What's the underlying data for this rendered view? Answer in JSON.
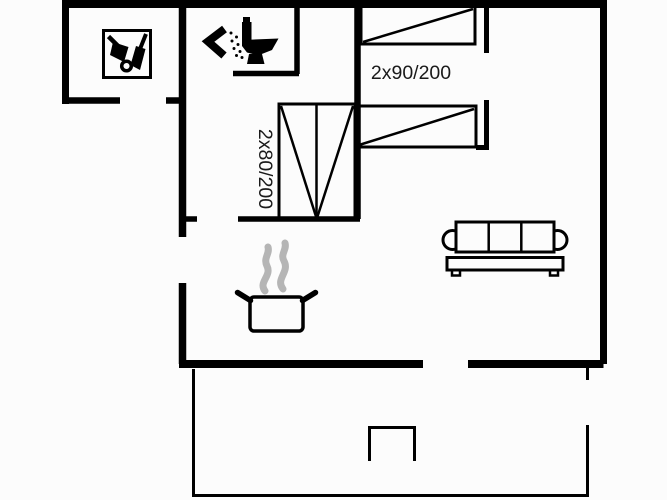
{
  "canvas": {
    "width": 667,
    "height": 500,
    "background": "#fcfcfc",
    "line_color": "#000000",
    "steam_color": "#b5b5b5",
    "text_color": "#1a1a1a"
  },
  "floorplan": {
    "labels": {
      "double_beds": "2x90/200",
      "bunk_bed": "2x80/200"
    },
    "symbols": [
      "garden-tools-icon",
      "shower-icon",
      "toilet-icon",
      "single-bed-symbol",
      "single-bed-symbol",
      "bunk-bed-symbol",
      "sofa-symbol",
      "cooking-pot-icon",
      "steam-icon",
      "terrace-outline",
      "terrace-square"
    ]
  }
}
